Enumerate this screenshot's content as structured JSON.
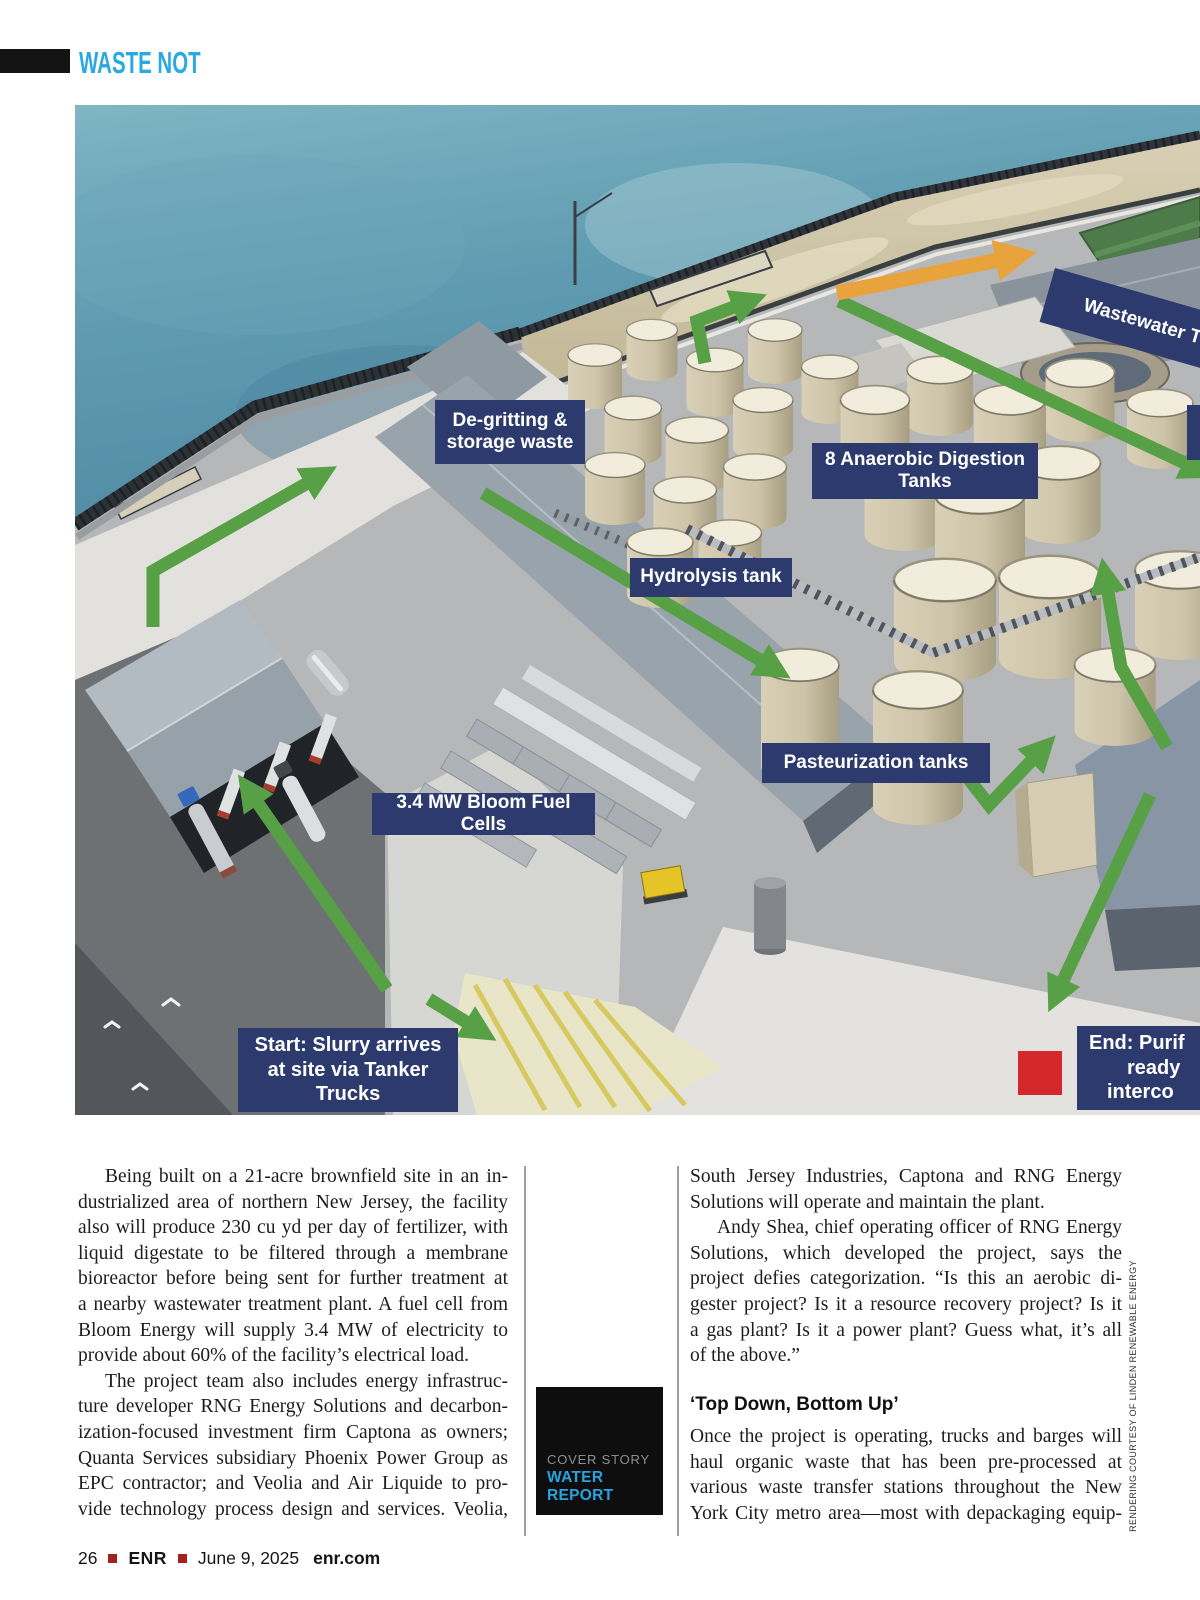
{
  "header": {
    "tag_label": "WASTE NOT"
  },
  "figure": {
    "labels": {
      "degritting": {
        "lines": [
          "De-gritting &",
          "storage waste"
        ]
      },
      "digestion": {
        "lines": [
          "8 Anaerobic Digestion",
          "Tanks"
        ]
      },
      "hydrolysis": {
        "lines": [
          "Hydrolysis tank"
        ]
      },
      "pasteurization": {
        "lines": [
          "Pasteurization tanks"
        ]
      },
      "fuel_cells": {
        "lines": [
          "3.4 MW Bloom Fuel Cells"
        ]
      },
      "start": {
        "lines": [
          "Start: Slurry arrives",
          "at site via Tanker",
          "Trucks"
        ]
      },
      "end": {
        "lines": [
          "End: Purif",
          "ready",
          "interco"
        ]
      },
      "wastewater": {
        "lines": [
          "Wastewater T"
        ]
      }
    },
    "credit": "RENDERING COURTESY OF LINDEN RENEWABLE ENERGY"
  },
  "article": {
    "left_lines": [
      "Being built on a 21-acre brownfield site in an in-",
      "dustrialized area of northern New Jersey, the facility",
      "also will produce 230 cu yd per day of fertilizer, with",
      "liquid digestate to be filtered through a membrane",
      "bioreactor before being sent for further treatment at",
      "a nearby wastewater treatment plant. A fuel cell from",
      "Bloom Energy will supply 3.4 MW of electricity to",
      "provide about 60% of the facility’s electrical load.",
      "The project team also includes energy infrastruc-",
      "ture developer RNG Energy Solutions and decarbon-",
      "ization-focused investment firm Captona as owners;",
      "Quanta Services subsidiary Phoenix Power Group as",
      "EPC contractor; and Veolia and Air Liquide to pro-",
      "vide technology process design and services. Veolia,"
    ],
    "right_top_lines": [
      "South Jersey Industries, Captona and RNG Energy",
      "Solutions will operate and maintain the plant.",
      "Andy Shea, chief operating officer of RNG Energy",
      "Solutions, which developed the project, says the",
      "project defies categorization. “Is this an aerobic di-",
      "gester project? Is it a resource recovery project? Is it",
      "a gas plant? Is it a power plant? Guess what, it’s all",
      "of the above.”"
    ],
    "subhead": "‘Top Down, Bottom Up’",
    "right_bottom_lines": [
      "Once the project is operating, trucks and barges will",
      "haul organic waste that has been pre-processed at",
      "various waste transfer stations throughout the New",
      "York City metro area—most with depackaging equip-"
    ]
  },
  "badge": {
    "kicker": "COVER STORY",
    "title": "WATER REPORT"
  },
  "footer": {
    "page_number": "26",
    "brand": "ENR",
    "date": "June 9, 2025",
    "site": "enr.com"
  },
  "colors": {
    "accent_cyan": "#29a9e1",
    "label_navy": "#2d3a6e",
    "arrow_green": "#57a046",
    "arrow_orange": "#e8a33d",
    "footer_red": "#a6201e",
    "water_teal": "#5b97ad"
  }
}
